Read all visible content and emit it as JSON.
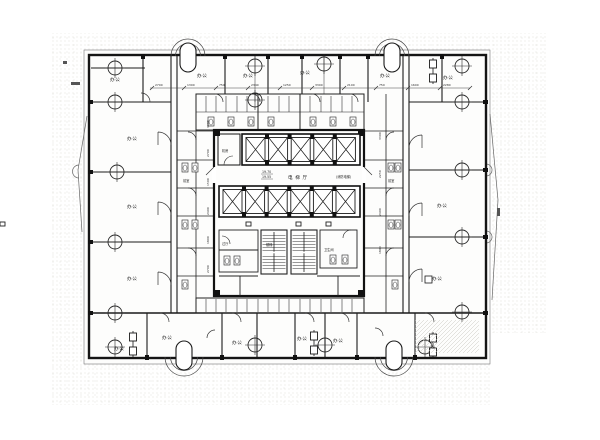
{
  "labels": {
    "office": "办公",
    "elevator_hall": "电 梯 厅",
    "fire_elevator": "(消防电梯)",
    "vestibule": "前室",
    "toilet": "卫生间",
    "machine_room": "机房",
    "stair": "楼梯",
    "lobby": "过厅"
  },
  "levels": {
    "upper": "19.70",
    "lower": "19.55"
  },
  "dims": {
    "top": [
      "2700",
      "1300",
      "750",
      "2340",
      "1250",
      "3300",
      "2100",
      "750",
      "1600",
      "2280"
    ],
    "left": [
      "3300",
      "2700",
      "1500",
      "2400",
      "1800",
      "2700"
    ],
    "right": [
      "3300",
      "2250",
      "2400",
      "1800"
    ]
  },
  "colors": {
    "line": "#1a1a1a",
    "paper": "#ffffff",
    "noise_dot": "#d4d3cc",
    "hatch": "#c9c8c0"
  }
}
